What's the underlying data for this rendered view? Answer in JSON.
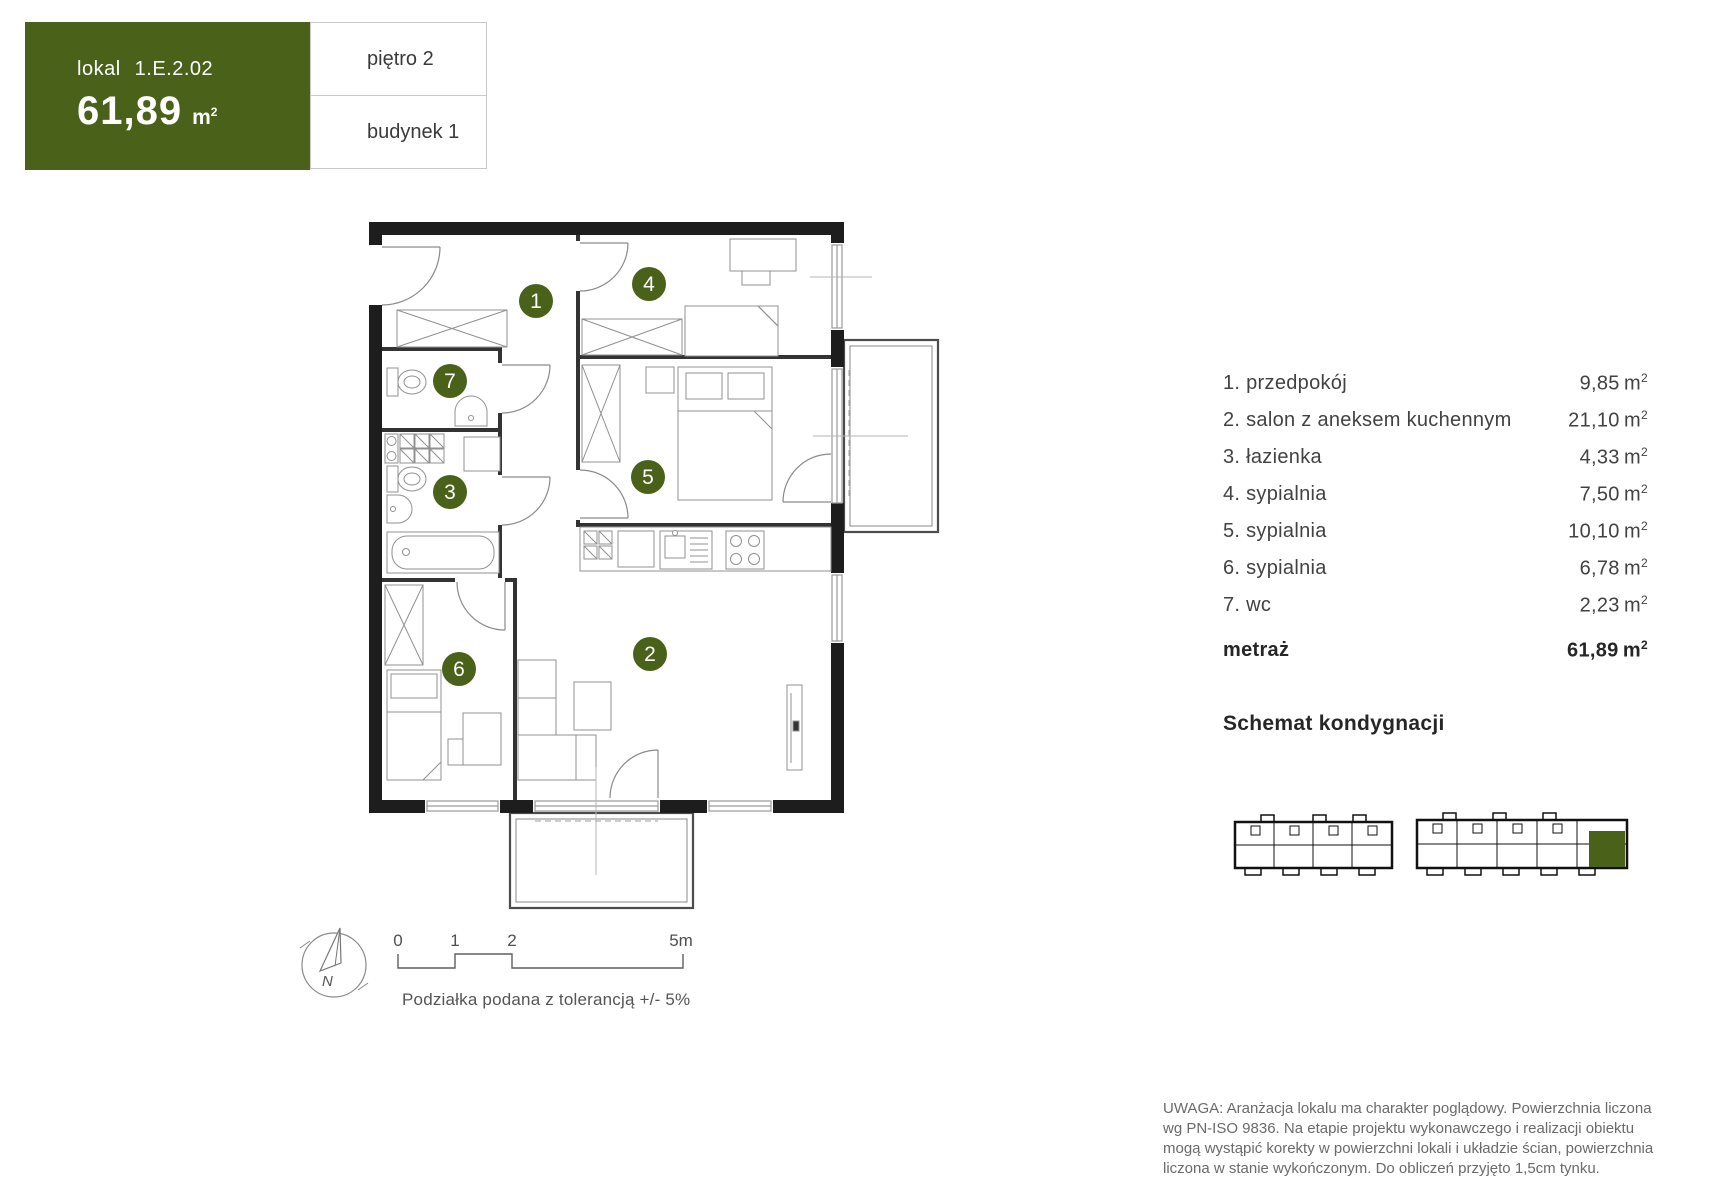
{
  "header": {
    "lokal_label": "lokal",
    "lokal_number": "1.E.2.02",
    "area_value": "61,89",
    "floor": "piętro 2",
    "building": "budynek 1"
  },
  "colors": {
    "accent_green": "#4a611a",
    "wall_black": "#1d1d1d"
  },
  "units": {
    "base": "m",
    "sup": "2"
  },
  "rooms": [
    {
      "num": "1",
      "label": "1. przedpokój",
      "area": "9,85"
    },
    {
      "num": "2",
      "label": "2. salon z aneksem kuchennym",
      "area": "21,10"
    },
    {
      "num": "3",
      "label": "3. łazienka",
      "area": "4,33"
    },
    {
      "num": "4",
      "label": "4. sypialnia",
      "area": "7,50"
    },
    {
      "num": "5",
      "label": "5. sypialnia",
      "area": "10,10"
    },
    {
      "num": "6",
      "label": "6. sypialnia",
      "area": "6,78"
    },
    {
      "num": "7",
      "label": "7. wc",
      "area": "2,23"
    }
  ],
  "total": {
    "label": "metraż",
    "value": "61,89"
  },
  "schemat": {
    "title": "Schemat kondygnacji"
  },
  "scale": {
    "ticks": [
      "0",
      "1",
      "2",
      "5m"
    ],
    "caption": "Podziałka podana z tolerancją +/- 5%"
  },
  "compass": {
    "north": "N"
  },
  "disclaimer": {
    "lines": [
      "UWAGA: Aranżacja lokalu ma charakter poglądowy. Powierzchnia liczona",
      "wg PN-ISO 9836. Na etapie projektu wykonawczego i realizacji obiektu",
      "mogą wystąpić korekty w powierzchni lokali i układzie ścian, powierzchnia",
      "liczona w stanie wykończonym. Do obliczeń przyjęto 1,5cm tynku."
    ]
  }
}
